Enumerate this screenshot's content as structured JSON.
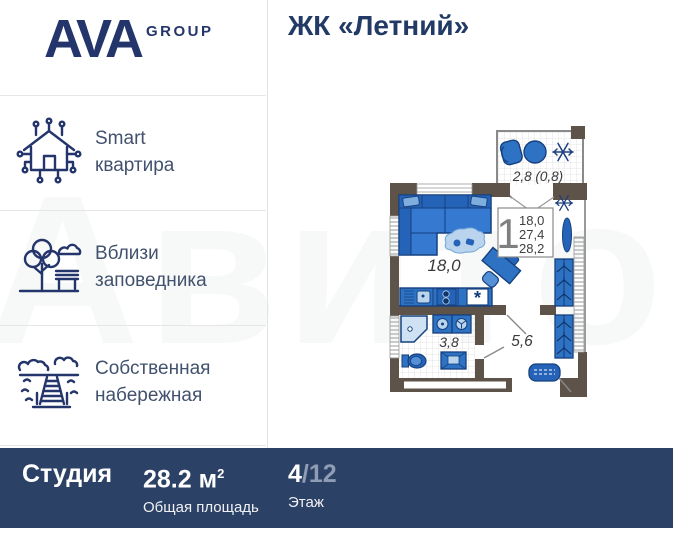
{
  "header": {
    "logo_main": "AVA",
    "logo_sub": "GROUP",
    "title": "ЖК «Летний»"
  },
  "sidebar": {
    "items": [
      {
        "icon": "smart-home-icon",
        "line1": "Smart",
        "line2": "квартира"
      },
      {
        "icon": "park-icon",
        "line1": "Вблизи",
        "line2": "заповедника"
      },
      {
        "icon": "embankment-icon",
        "line1": "Собственная",
        "line2": "набережная"
      }
    ]
  },
  "floor_plan": {
    "balcony_label": "2,8 (0,8)",
    "legend": {
      "rooms": "1",
      "area_living": "18,0",
      "area_no_balcony": "27,4",
      "area_total": "28,2"
    },
    "labels": {
      "living_room": "18,0",
      "bathroom": "3,8",
      "hallway": "5,6"
    },
    "kitchen_marker": "*"
  },
  "footer": {
    "type": "Студия",
    "area": "28.2 м",
    "area_sup": "2",
    "area_caption": "Общая площадь",
    "floor_current": "4",
    "floor_total": "/12",
    "floor_caption": "Этаж"
  },
  "watermark": "Авито",
  "colors": {
    "brand_navy": "#24356b",
    "bar_navy": "#2c4166",
    "wall": "#5d5348",
    "furniture_blue": "#2e72c4",
    "furniture_dark": "#2563b8",
    "outline_navy": "#16407e",
    "pale_blue": "#b9d4ec",
    "floor_muted": "#8e9cb5"
  }
}
